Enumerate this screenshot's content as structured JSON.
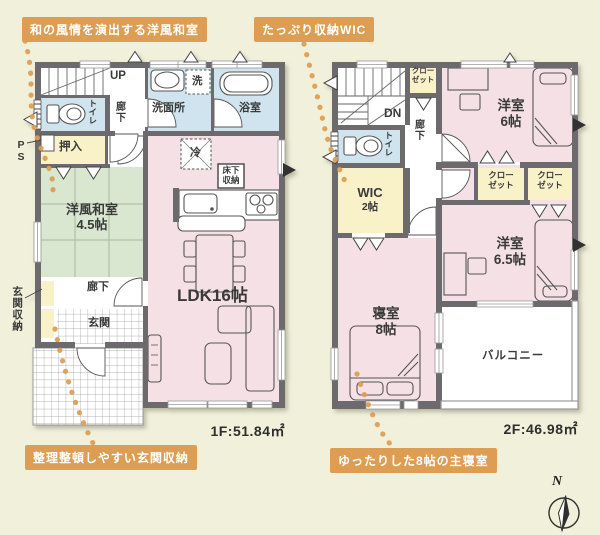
{
  "callouts": {
    "top_left": "和の風情を演出する洋風和室",
    "top_center": "たっぷり収納WIC",
    "bottom_left": "整理整頓しやすい玄関収納",
    "bottom_right": "ゆったりした8帖の主寝室"
  },
  "floor1": {
    "area_label": "1F:51.84㎡",
    "labels": {
      "up": "UP",
      "hall_upper": "廊下",
      "toilet": "トイレ",
      "laundry": "洗",
      "washroom": "洗面所",
      "bathroom": "浴室",
      "pipe_space": "PS",
      "oshiire": "押入",
      "fridge": "冷",
      "underfloor1": "床下",
      "underfloor2": "収納",
      "washitsu1": "洋風和室",
      "washitsu2": "4.5帖",
      "ldk": "LDK16帖",
      "hall_lower": "廊下",
      "entrance_storage": "玄関収納",
      "entrance": "玄関"
    }
  },
  "floor2": {
    "area_label": "2F:46.98㎡",
    "labels": {
      "dn": "DN",
      "hall_closet1": "クロー",
      "hall_closet2": "ゼット",
      "hall": "廊下",
      "toilet": "トイレ",
      "wic1": "WIC",
      "wic2": "2帖",
      "bedroom1": "寝室",
      "bedroom2": "8帖",
      "room6_1": "洋室",
      "room6_2": "6帖",
      "closet_a1": "クロー",
      "closet_a2": "ゼット",
      "closet_b1": "クロー",
      "closet_b2": "ゼット",
      "room65_1": "洋室",
      "room65_2": "6.5帖",
      "balcony": "バルコニー"
    }
  },
  "compass": {
    "north": "N"
  },
  "colors": {
    "background": "#f1f0db",
    "wall": "#6c6b6d",
    "room_pink": "#f4e0e5",
    "room_blue": "#cfe4ee",
    "room_yellow": "#f9f1c8",
    "tatami_green": "#d9e6d0",
    "accent_orange": "#dd9e53",
    "text": "#3a3a3a"
  }
}
